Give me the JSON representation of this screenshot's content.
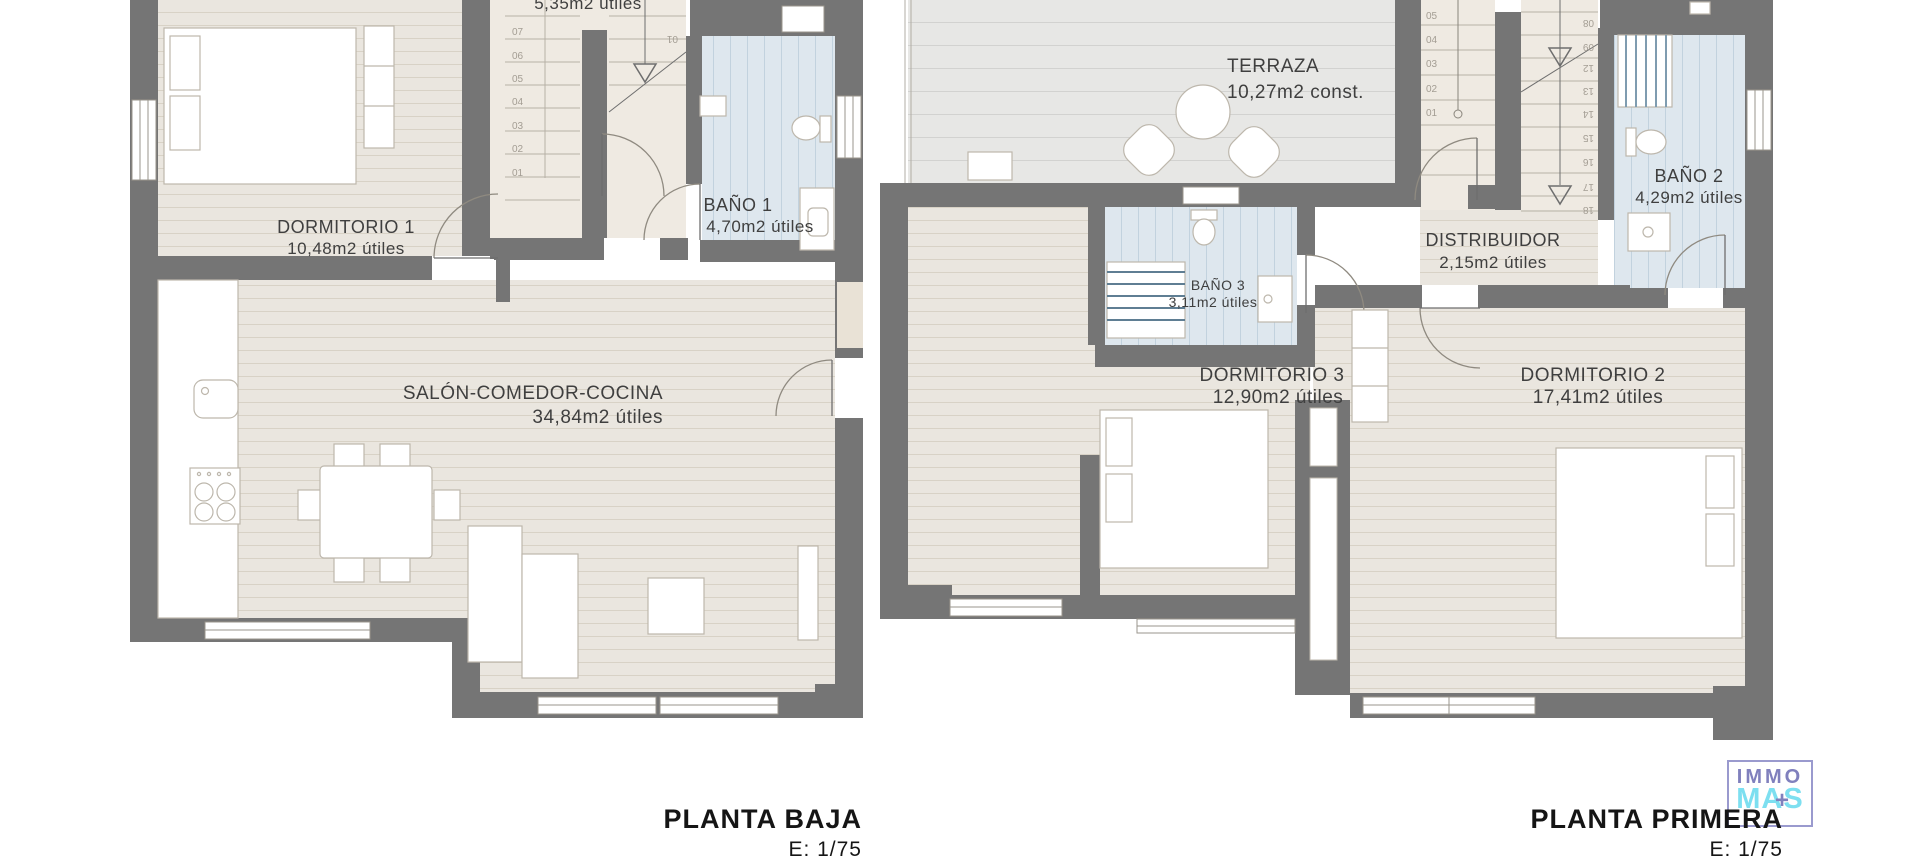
{
  "colors": {
    "wall": "#757575",
    "floor_wood": "#eae6df",
    "floor_wood_line": "#d8d2c6",
    "floor_terrace": "#e7e7e5",
    "floor_bath": "#dee7ee",
    "bath_stripe": "#c2d2de",
    "furniture_outline": "#bdb7ac",
    "label_text": "#3f3f3f",
    "logo_purple": "#8080bd",
    "logo_cyan": "#7ddff0"
  },
  "planta_baja": {
    "title": "PLANTA BAJA",
    "scale": "E: 1/75",
    "partial_area_label": "5,35m2 útiles",
    "rooms": {
      "dormitorio1": {
        "name": "DORMITORIO 1",
        "area": "10,48m2 útiles"
      },
      "bano1": {
        "name": "BAÑO 1",
        "area": "4,70m2 útiles"
      },
      "salon": {
        "name": "SALÓN-COMEDOR-COCINA",
        "area": "34,84m2 útiles"
      }
    },
    "stair_numbers": [
      "01",
      "02",
      "03",
      "04",
      "05",
      "06",
      "07"
    ],
    "upper_step_label": "01"
  },
  "planta_primera": {
    "title": "PLANTA PRIMERA",
    "scale": "E: 1/75",
    "rooms": {
      "terraza": {
        "name": "TERRAZA",
        "area": "10,27m2 const."
      },
      "bano2": {
        "name": "BAÑO 2",
        "area": "4,29m2 útiles"
      },
      "bano3": {
        "name": "BAÑO 3",
        "area": "3,11m2 útiles"
      },
      "distribuidor": {
        "name": "DISTRIBUIDOR",
        "area": "2,15m2 útiles"
      },
      "dormitorio3": {
        "name": "DORMITORIO 3",
        "area": "12,90m2 útiles"
      },
      "dormitorio2": {
        "name": "DORMITORIO 2",
        "area": "17,41m2 útiles"
      }
    },
    "stair_numbers_lower": [
      "01",
      "02",
      "03",
      "04",
      "05"
    ],
    "stair_numbers_upper": [
      "08",
      "09",
      "12",
      "13",
      "14",
      "15",
      "16",
      "17",
      "18"
    ]
  },
  "logo": {
    "line1": "IMMO",
    "line2": "MAS",
    "plus": "+"
  }
}
